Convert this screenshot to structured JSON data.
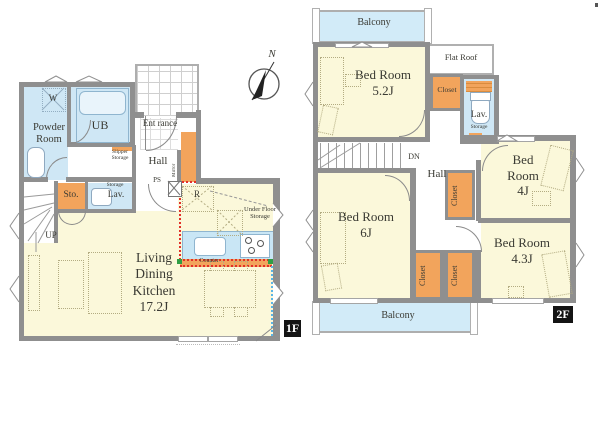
{
  "compass": {
    "n": "N"
  },
  "colors": {
    "wall": "#8f8f8f",
    "room_yellow": "#fbf8da",
    "wet_blue": "#cfe7f5",
    "balcony_blue": "#d2ebf8",
    "closet_orange": "#f2a45c",
    "counter_blue": "#c9e6f5",
    "kitchen_boundary_red": "#e23028",
    "window_boundary_blue": "#5bb5e6",
    "corner_mark_green": "#2f9e44"
  },
  "floor1": {
    "badge": "1F",
    "powder_room": "Powder Room",
    "washer": "W",
    "ub": "UB",
    "entrance": "Ent rance",
    "hall": "Hall",
    "slipper_storage": "Slipper Storage",
    "mirror": "Mirror",
    "ps": "PS",
    "sto": "Sto.",
    "lav_storage": "Storage",
    "lav": "Lav.",
    "up": "UP",
    "fridge": "R",
    "under_floor_storage": "Under Floor Storage",
    "counter": "Counter",
    "ldk_name": "Living Dining Kitchen",
    "ldk_size": "17.2J"
  },
  "floor2": {
    "badge": "2F",
    "balcony_top": "Balcony",
    "balcony_bottom": "Balcony",
    "flat_roof": "Flat Roof",
    "bed52_name": "Bed Room",
    "bed52_size": "5.2J",
    "bed4_name": "Bed Room",
    "bed4_size": "4J",
    "bed6_name": "Bed Room",
    "bed6_size": "6J",
    "bed43_name": "Bed Room",
    "bed43_size": "4.3J",
    "closet_52": "Closet",
    "closet_4j": "Closet",
    "closet_6j_a": "Closet",
    "closet_6j_b": "Closet",
    "lav": "Lav.",
    "lav_storage": "Storage",
    "dn": "DN",
    "hall": "Hall"
  }
}
